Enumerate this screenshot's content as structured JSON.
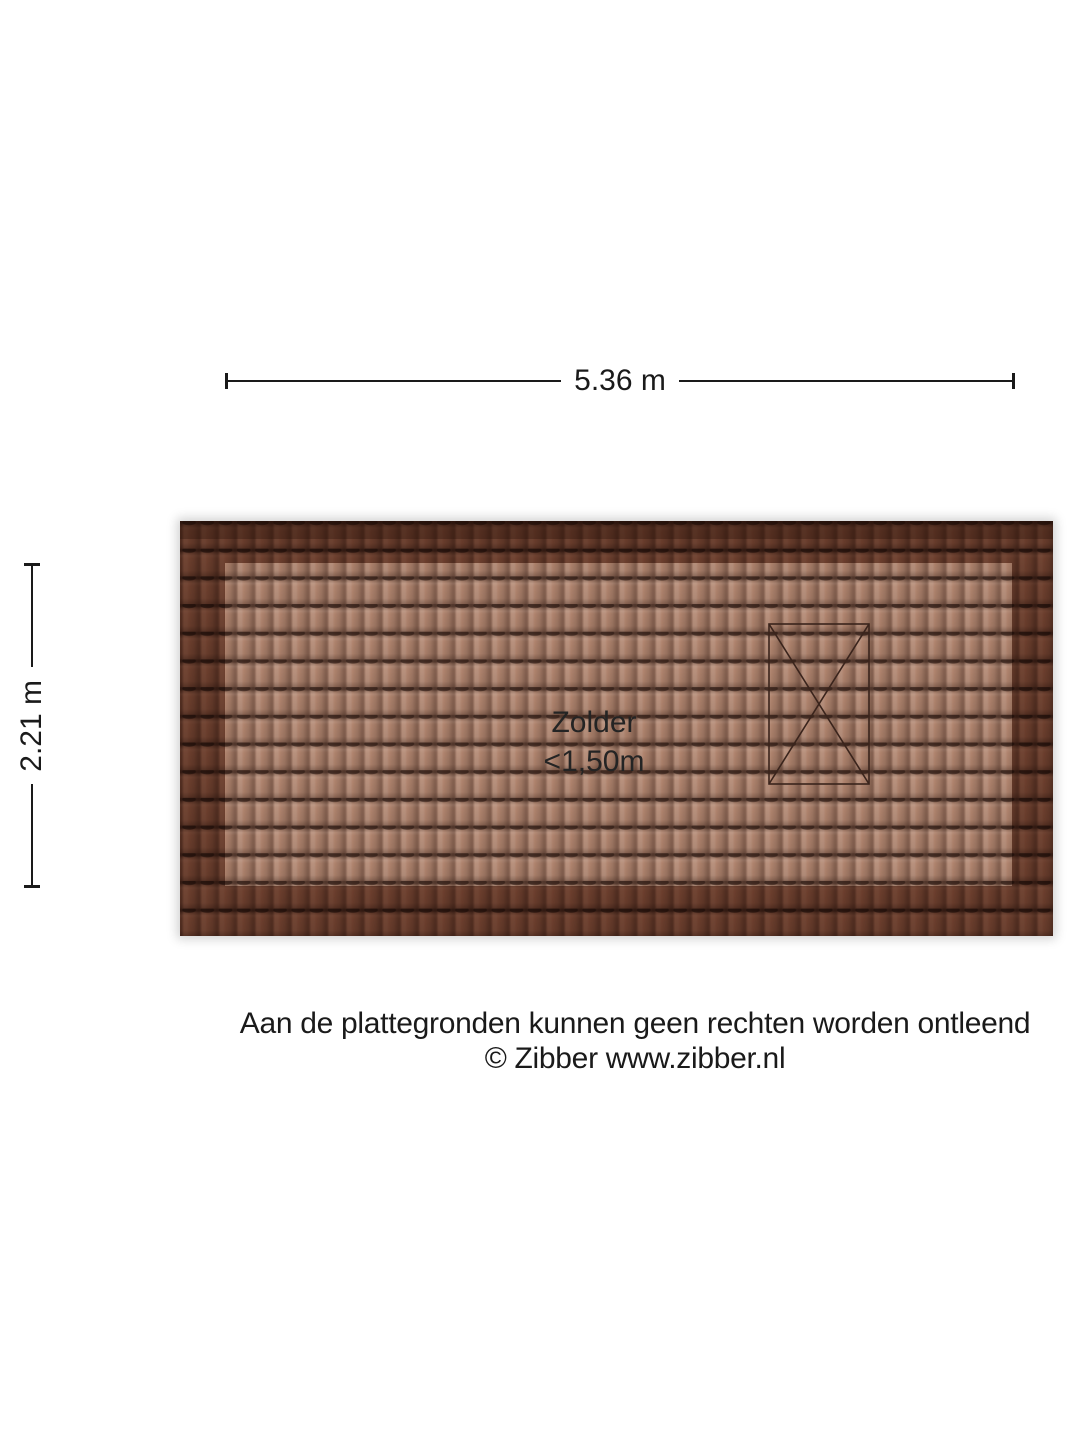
{
  "dimensions": {
    "width_label": "5.36 m",
    "height_label": "2.21 m"
  },
  "room": {
    "name": "Zolder",
    "height_note": "<1,50m"
  },
  "footer": {
    "line1": "Aan de plattegronden kunnen geen rechten worden ontleend",
    "line2": "© Zibber www.zibber.nl"
  },
  "symbols": {
    "roof_window": "x-marked-rectangle"
  },
  "colors": {
    "roof_tile_light": "#b0846e",
    "roof_tile_dark": "#6f4a3c",
    "tile_groove": "#2e1a13",
    "window_outline": "#3a241c",
    "line": "#1a1a1a",
    "text": "#1a1a1a"
  }
}
